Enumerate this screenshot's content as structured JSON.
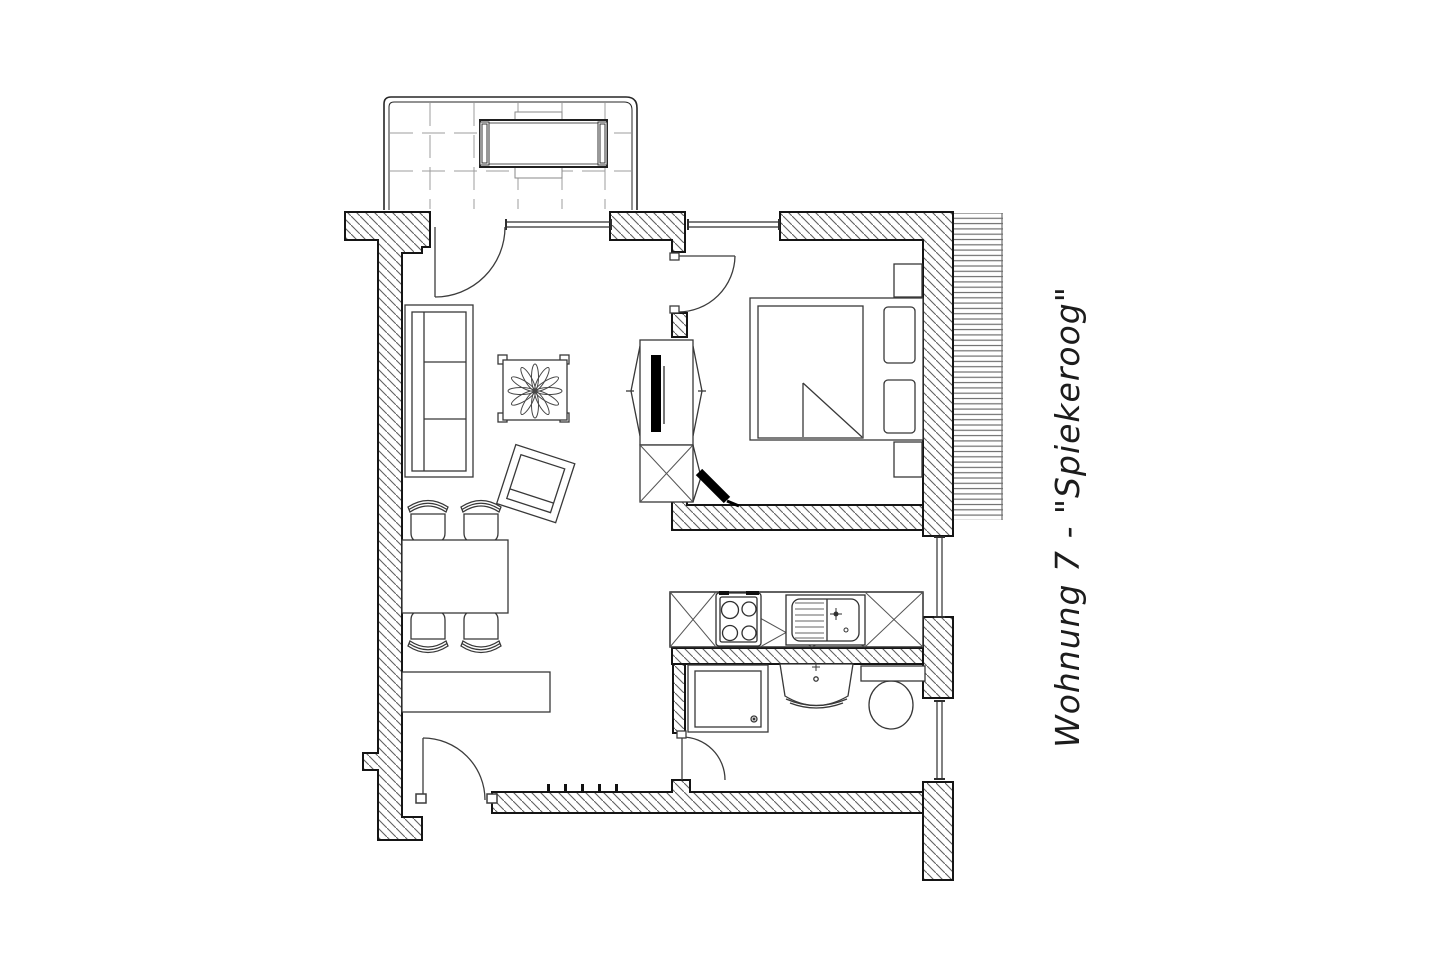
{
  "title": {
    "text": "Wohnung 7 - \"Spiekeroog\""
  },
  "plan": {
    "apartment_label": "Wohnung 7",
    "apartment_name": "Spiekeroog",
    "elements": [
      "balcony",
      "balcony-table",
      "balcony-benches",
      "sofa",
      "coffee-table",
      "plant",
      "armchair",
      "dining-table",
      "dining-chairs",
      "sideboard",
      "tv-cabinet",
      "tv-screen",
      "speaker",
      "double-bed",
      "mattress",
      "pillows",
      "nightstands",
      "kitchen-counter",
      "stove",
      "kitchen-sink",
      "tall-cabinets",
      "shower",
      "washbasin",
      "toilet",
      "entry-door",
      "balcony-door",
      "bedroom-door",
      "bathroom-door",
      "windows",
      "hatched-walls",
      "deck-lines",
      "coat-hooks"
    ]
  },
  "palette": {
    "background": "#ffffff",
    "wall_outline": "#151515",
    "hatch_line": "#606060",
    "furniture_line": "#383838",
    "tile_grid": "#9c9c9c",
    "deck_lines": "#6f6f6f",
    "tv_fill": "#000000"
  }
}
